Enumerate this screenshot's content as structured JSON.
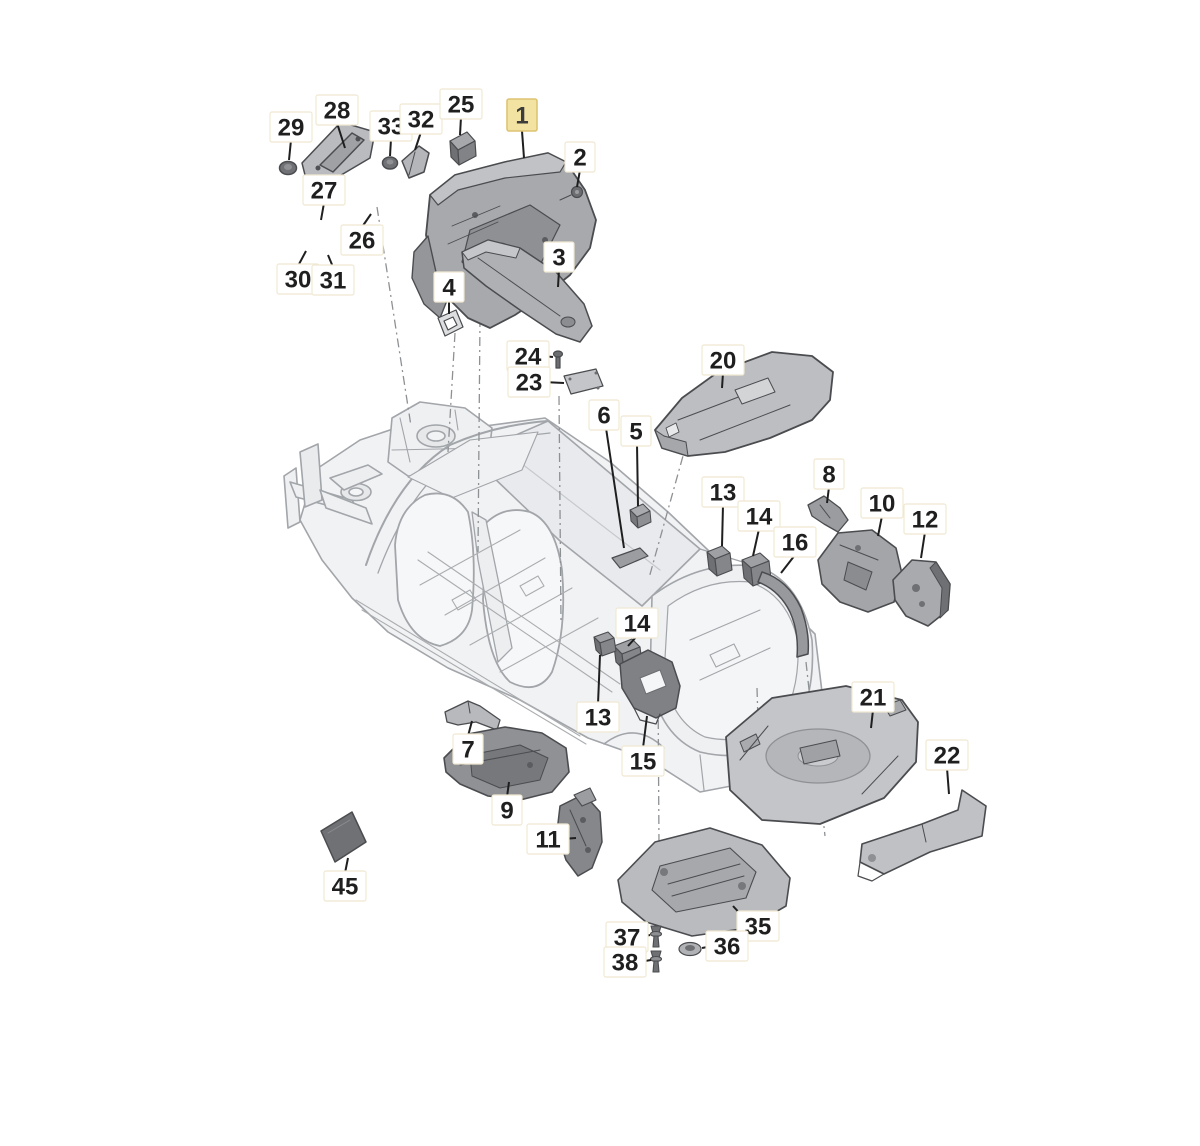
{
  "diagram": {
    "canvas": {
      "width": 1200,
      "height": 1146,
      "background": "#ffffff"
    },
    "style": {
      "label_font_size": 24,
      "label_text_color": "#1f1f1f",
      "label_bg": "#ffffff",
      "label_border": "#f0e8d2",
      "highlight_bg": "#f3e3a2",
      "highlight_border": "#ddc372",
      "highlight_text": "#3c3c3c",
      "leader_color": "#1f1f1f",
      "phantom_color": "#8e9194",
      "body_line": "#a2a5a9",
      "part_stroke": "#4a4c4f"
    },
    "callouts": [
      {
        "part": "29",
        "x": 291,
        "y": 127,
        "leader": [
          291,
          140,
          289,
          160
        ]
      },
      {
        "part": "28",
        "x": 337,
        "y": 110,
        "leader": [
          337,
          123,
          345,
          148
        ]
      },
      {
        "part": "33",
        "x": 391,
        "y": 126,
        "leader": [
          391,
          139,
          390,
          156
        ]
      },
      {
        "part": "32",
        "x": 421,
        "y": 119,
        "leader": [
          421,
          132,
          415,
          150
        ]
      },
      {
        "part": "25",
        "x": 461,
        "y": 104,
        "leader": [
          461,
          117,
          460,
          135
        ]
      },
      {
        "part": "1",
        "x": 522,
        "y": 115,
        "highlighted": true,
        "leader": [
          522,
          131,
          524,
          158
        ]
      },
      {
        "part": "2",
        "x": 580,
        "y": 157,
        "leader": [
          580,
          170,
          577,
          187
        ]
      },
      {
        "part": "27",
        "x": 324,
        "y": 190,
        "leader": [
          324,
          203,
          321,
          220
        ]
      },
      {
        "part": "26",
        "x": 362,
        "y": 240,
        "leader": [
          362,
          227,
          371,
          214
        ]
      },
      {
        "part": "30",
        "x": 298,
        "y": 279,
        "leader": [
          298,
          266,
          306,
          251
        ]
      },
      {
        "part": "31",
        "x": 333,
        "y": 280,
        "leader": [
          333,
          267,
          328,
          255
        ]
      },
      {
        "part": "4",
        "x": 449,
        "y": 287,
        "leader": [
          449,
          300,
          449,
          314
        ]
      },
      {
        "part": "3",
        "x": 559,
        "y": 257,
        "leader": [
          559,
          270,
          558,
          287
        ]
      },
      {
        "part": "24",
        "x": 528,
        "y": 356,
        "leader": [
          542,
          356,
          553,
          357
        ]
      },
      {
        "part": "23",
        "x": 529,
        "y": 382,
        "leader": [
          543,
          382,
          564,
          383
        ]
      },
      {
        "part": "20",
        "x": 723,
        "y": 360,
        "leader": [
          723,
          373,
          722,
          388
        ]
      },
      {
        "part": "6",
        "x": 604,
        "y": 415,
        "leader": [
          606,
          428,
          624,
          548
        ]
      },
      {
        "part": "5",
        "x": 636,
        "y": 431,
        "leader": [
          637,
          444,
          638,
          506
        ]
      },
      {
        "part": "13",
        "x": 723,
        "y": 492,
        "leader": [
          723,
          505,
          722,
          546
        ]
      },
      {
        "part": "14",
        "x": 759,
        "y": 516,
        "leader": [
          759,
          529,
          753,
          556
        ]
      },
      {
        "part": "8",
        "x": 829,
        "y": 474,
        "leader": [
          829,
          487,
          827,
          503
        ]
      },
      {
        "part": "10",
        "x": 882,
        "y": 503,
        "leader": [
          882,
          516,
          878,
          536
        ]
      },
      {
        "part": "12",
        "x": 925,
        "y": 519,
        "leader": [
          925,
          532,
          921,
          558
        ]
      },
      {
        "part": "16",
        "x": 795,
        "y": 542,
        "leader": [
          795,
          555,
          781,
          573
        ]
      },
      {
        "part": "14",
        "x": 637,
        "y": 623,
        "leader": [
          637,
          636,
          628,
          646
        ]
      },
      {
        "part": "13",
        "x": 598,
        "y": 717,
        "leader": [
          598,
          704,
          600,
          655
        ]
      },
      {
        "part": "15",
        "x": 643,
        "y": 761,
        "leader": [
          643,
          748,
          647,
          716
        ]
      },
      {
        "part": "7",
        "x": 468,
        "y": 749,
        "leader": [
          468,
          736,
          472,
          721
        ]
      },
      {
        "part": "9",
        "x": 507,
        "y": 810,
        "leader": [
          507,
          797,
          509,
          782
        ]
      },
      {
        "part": "11",
        "x": 548,
        "y": 839,
        "leader": [
          562,
          839,
          576,
          838
        ]
      },
      {
        "part": "21",
        "x": 873,
        "y": 697,
        "leader": [
          873,
          710,
          871,
          728
        ]
      },
      {
        "part": "22",
        "x": 947,
        "y": 755,
        "leader": [
          947,
          768,
          949,
          794
        ]
      },
      {
        "part": "45",
        "x": 345,
        "y": 886,
        "leader": [
          345,
          873,
          348,
          858
        ]
      },
      {
        "part": "35",
        "x": 758,
        "y": 926,
        "leader": [
          745,
          919,
          733,
          906
        ]
      },
      {
        "part": "37",
        "x": 627,
        "y": 937,
        "leader": [
          641,
          937,
          650,
          935
        ]
      },
      {
        "part": "36",
        "x": 727,
        "y": 946,
        "leader": [
          713,
          946,
          702,
          948
        ]
      },
      {
        "part": "38",
        "x": 625,
        "y": 962,
        "leader": [
          639,
          962,
          651,
          960
        ]
      }
    ],
    "phantom_lines": [
      [
        377,
        207,
        411,
        426
      ],
      [
        455,
        333,
        448,
        452
      ],
      [
        480,
        318,
        478,
        552
      ],
      [
        559,
        396,
        561,
        621
      ],
      [
        688,
        438,
        649,
        578
      ],
      [
        658,
        682,
        659,
        847
      ],
      [
        757,
        688,
        761,
        821
      ],
      [
        806,
        662,
        825,
        836
      ]
    ]
  }
}
